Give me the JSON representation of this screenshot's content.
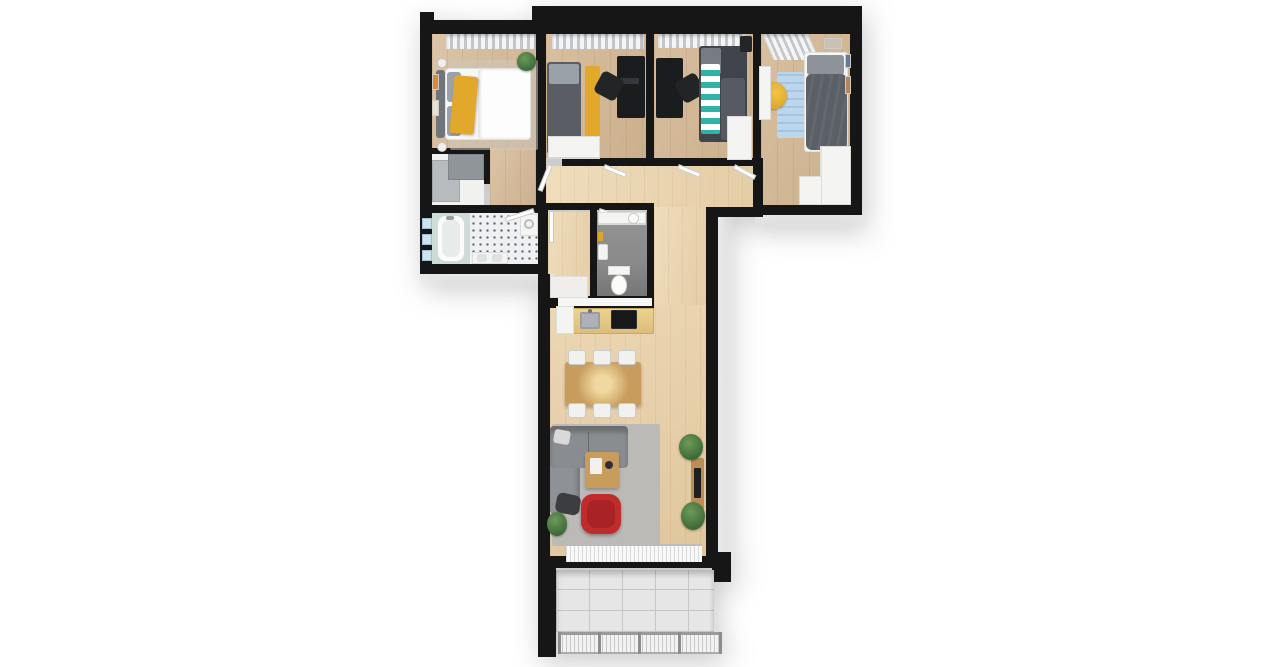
{
  "scene": {
    "type": "3d-floor-plan-top-view",
    "description": "Photoreal top-down 3D render of a T-shaped apartment floor plan on a white background, no text labels",
    "rooms": [
      {
        "id": "master-bedroom",
        "furniture": [
          "double-bed-white-duvet",
          "yellow-throw-blanket",
          "gray-headboard",
          "wall-art-orange",
          "window-curtains",
          "plant",
          "gray-rug"
        ]
      },
      {
        "id": "walk-in-closet",
        "furniture": [
          "gray-cabinets"
        ]
      },
      {
        "id": "bathroom",
        "furniture": [
          "bathtub",
          "patterned-tile-floor",
          "vanity-sink",
          "washing-machine",
          "teal-wet-zone",
          "small-windows"
        ]
      },
      {
        "id": "bedroom-2",
        "furniture": [
          "single-bed-dark",
          "yellow-rug",
          "black-desk",
          "desk-chair",
          "white-wardrobe",
          "window-curtains"
        ]
      },
      {
        "id": "bedroom-3",
        "furniture": [
          "black-desk",
          "desk-chair",
          "bed-teal-striped",
          "dark-duvet",
          "shelf",
          "white-cabinet",
          "window-curtains"
        ]
      },
      {
        "id": "bedroom-4",
        "furniture": [
          "single-bed-gray",
          "blue-plaid-rug",
          "yellow-pouf",
          "white-desk",
          "white-dresser",
          "wall-frames",
          "window-curtains"
        ]
      },
      {
        "id": "hallway",
        "furniture": [
          "white-interior-doors"
        ]
      },
      {
        "id": "wc",
        "furniture": [
          "toilet",
          "wall-cabinet",
          "small-sink",
          "yellow-towel",
          "gray-floor"
        ]
      },
      {
        "id": "entry-hall",
        "furniture": [
          "entry-door",
          "floor-mat"
        ]
      },
      {
        "id": "kitchen-nook",
        "furniture": [
          "counter",
          "sink",
          "black-cooktop",
          "white-cabinet"
        ]
      },
      {
        "id": "living-room",
        "furniture": [
          "corner-sofa-gray",
          "gray-rug",
          "wood-coffee-table",
          "red-armchair",
          "dark-pouf",
          "dining-table-6-chairs",
          "tv-console",
          "plants",
          "window-blinds"
        ]
      },
      {
        "id": "balcony",
        "furniture": [
          "tiled-floor",
          "railing"
        ]
      }
    ]
  },
  "colors": {
    "wall": "#161616",
    "exterior": "#ffffff",
    "bedroom_floor": "#d8bf9f",
    "master_floor": "#dcc4a6",
    "hall_floor": "#efddbc",
    "living_floor": "#ecd7b4",
    "closet_floor": "#f1f1ef",
    "curtain_light": "#f5f5f5",
    "curtain_dark": "#c3c7cc",
    "accent_yellow": "#e2a82c",
    "accent_teal": "#2fb3a6",
    "accent_red": "#c02b2c",
    "bed_dark": "#5a5e64",
    "duvet_gray": "#5b5f66",
    "pillow_gray": "#9ba1a8",
    "furniture_black": "#1b1c1e",
    "furniture_white": "#f4f4f2",
    "wood_furniture": "#c79c5c",
    "sofa_gray": "#898c90",
    "rug_gray": "#bcbab6",
    "plant_green": "#3f6b3a",
    "blue_rug": "#bcd6ec",
    "wc_floor": "#8a8a8a",
    "bath_tile": "#eef0f2",
    "bath_dot": "#5a6068",
    "tub_zone": "#ccdcd8",
    "balcony_tile": "#e6e6e6",
    "balcony_line": "#c6c6c6",
    "railing_light": "#f2f2f2"
  }
}
